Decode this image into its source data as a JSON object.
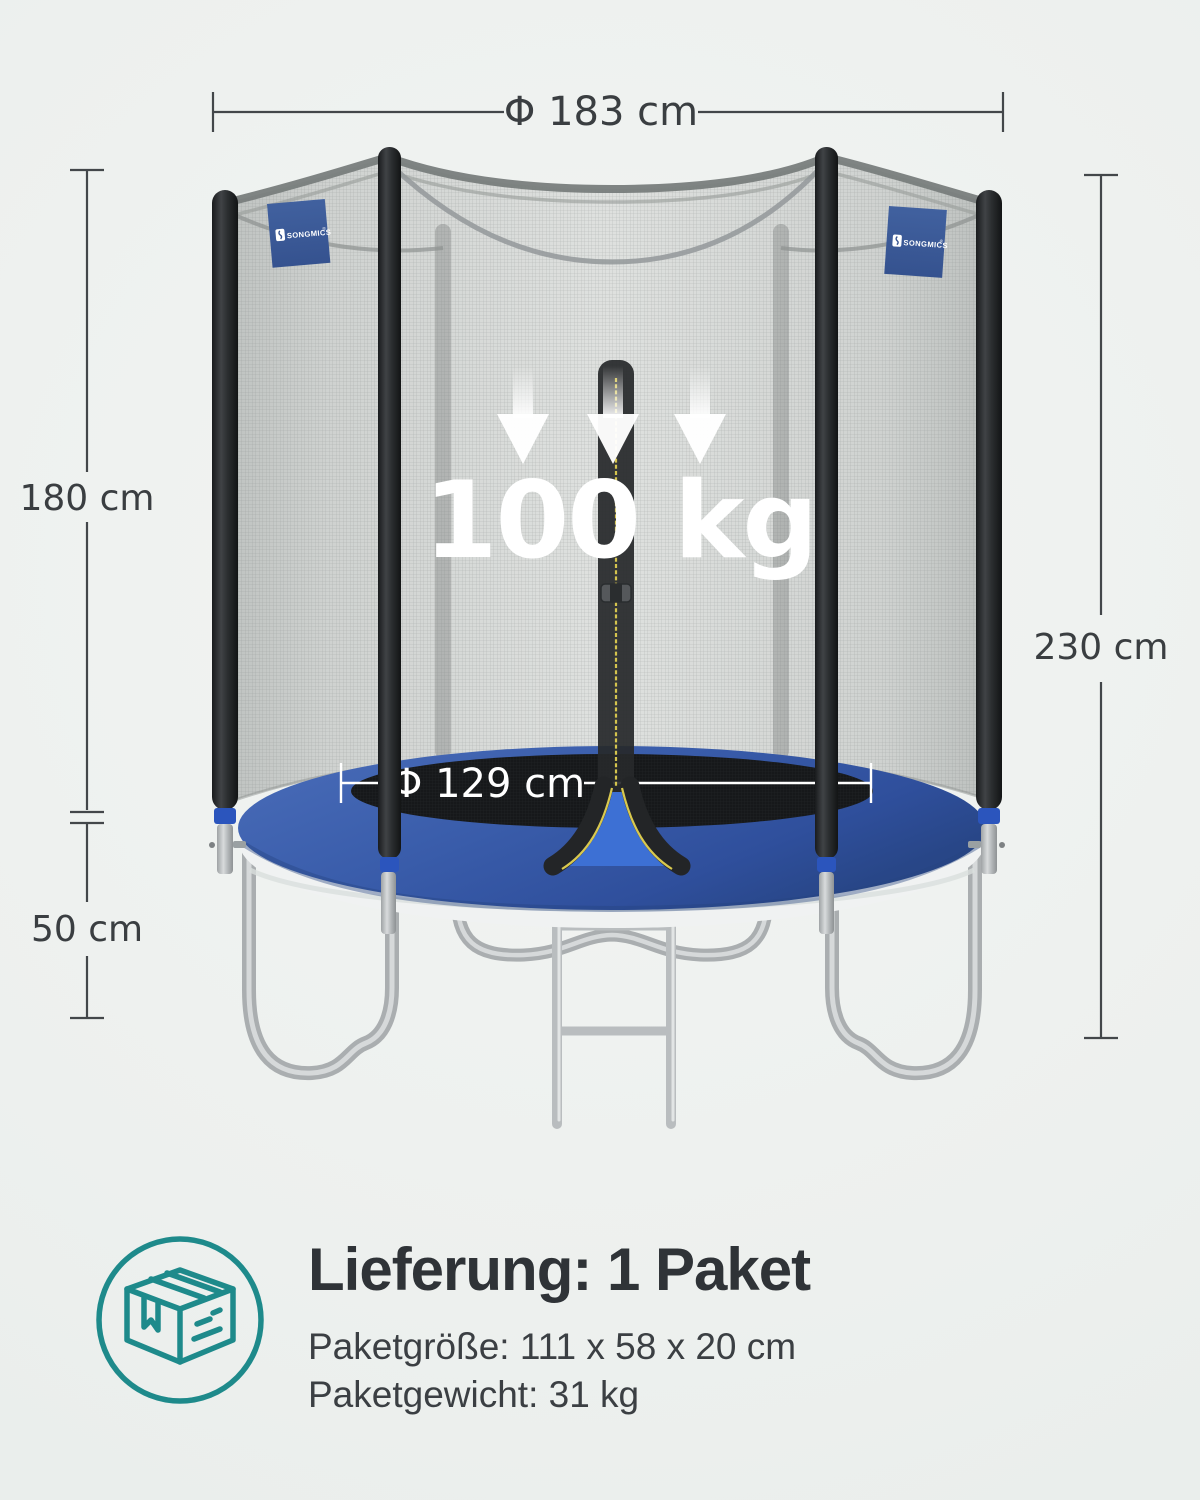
{
  "dimensions": {
    "outer_diameter": "Φ 183 cm",
    "net_height": "180 cm",
    "base_height": "50 cm",
    "total_height": "230 cm",
    "jumping_diameter": "Φ 129 cm",
    "max_load": "100 kg"
  },
  "brand": {
    "tag_label": "SONGMICS",
    "reg_mark": "®"
  },
  "delivery": {
    "heading": "Lieferung: 1 Paket",
    "package_size": "Paketgröße: 111 x 58 x 20 cm",
    "package_weight": "Paketgewicht: 31 kg"
  },
  "colors": {
    "accent_teal": "#1e8a8b",
    "pad_blue": "#3a5dab",
    "tag_blue": "#3c5a9d",
    "band_blue": "#2b55bd",
    "text_dark": "#3a3e41",
    "background": "#edf0ee"
  }
}
